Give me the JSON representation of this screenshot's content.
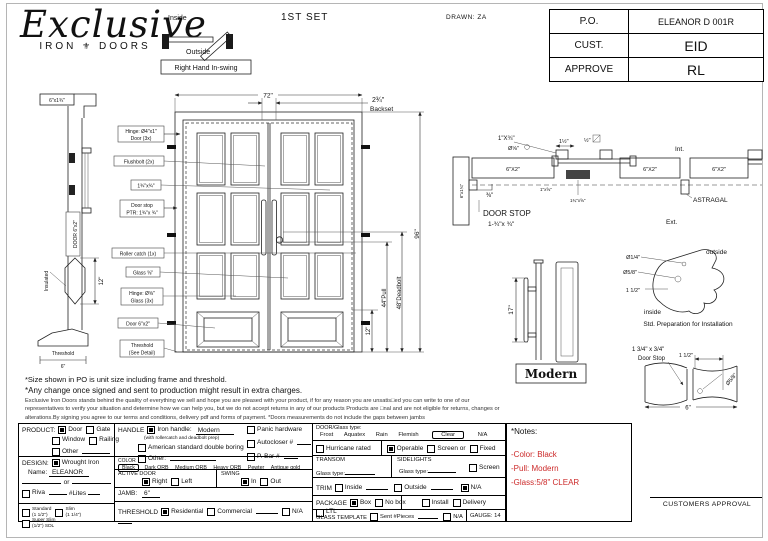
{
  "header": {
    "logo": {
      "script": "Exclusive",
      "sub_left": "IRON",
      "ornament": "⚜",
      "sub_right": "DOORS"
    },
    "set_label": "1ST SET",
    "drawn": "DRAWN: ZA",
    "swing": {
      "inside": "Inside",
      "outside": "Outside",
      "caption": "Right Hand In-swing"
    },
    "po_table": [
      [
        "P.O.",
        "ELEANOR D 001R"
      ],
      [
        "CUST.",
        "EID"
      ],
      [
        "APPROVE",
        "RL"
      ]
    ]
  },
  "drawing": {
    "elevation": {
      "dim_width": "72\"",
      "backset_value": "2¾\"",
      "backset_label": "Backset",
      "dim_height": "96\"",
      "dim_pull": "44\"Pull",
      "dim_deadbolt": "48\"Deadbolt",
      "dim_panel": "12\"",
      "callouts": [
        {
          "l1": "Hinge: Ø4\"x1\"",
          "l2": "Door (3x)"
        },
        {
          "l1": "Flushbolt (2x)"
        },
        {
          "l1": "1¾\"x¾\""
        },
        {
          "l1": "Door stop",
          "l2": "PTR: 1¾\"x ¾\""
        },
        {
          "l1": "Roller catch  (1x)"
        },
        {
          "l1": "Glass ⅝\""
        },
        {
          "l1": "Hinge: Ø⅝\"",
          "l2": "Glass (3x)"
        },
        {
          "l1": "Door 6\"x2\""
        },
        {
          "l1": "Threshold",
          "l2": "(See Detail)"
        }
      ]
    },
    "jamb": {
      "top": "6\"x1¾\"",
      "door": "DOOR 6\"x2\"",
      "insulated": "Insulated",
      "dim": "12\"",
      "threshold": "Threshold",
      "threshold_dim": "6\""
    },
    "plan": {
      "l_1x34": "1\"X¾\"",
      "l_d58": "Ø⅝\"",
      "l_112": "1½\"",
      "l_12": "½\"",
      "j1": "6\"X2\"",
      "j2": "6\"X2\"",
      "j3": "6\"X2\"",
      "l_38": "⅜\"",
      "side": "6\"x1¾\"",
      "int": "Int.",
      "ext": "Ext.",
      "astragal": "ASTRAGAL",
      "doorstop1": "DOOR STOP",
      "doorstop2": "1-¾\"x ¾\"",
      "t1": "1\"x⅝\"",
      "t2": "1¾\"x⅝\""
    },
    "handle": {
      "dim": "17\"",
      "name": "Modern"
    },
    "profile": {
      "d14": "Ø1/4\"",
      "d58": "Ø5/8\"",
      "d112": "1 1/2\"",
      "outside": "outside",
      "inside": "inside",
      "caption": "Std. Preparation for Installation"
    },
    "corner": {
      "size": "1 3/4\" x 3/4\"",
      "name": "Door Stop",
      "d112": "1 1/2\"",
      "d58": "Ø5/8\"",
      "d6": "6\""
    }
  },
  "notes": {
    "line1": "*Size shown in PO is unit size including frame and threshold.",
    "line2": "*Any change once signed and sent to production might result in extra charges.",
    "fine_print": "Exclusive Iron Doors stands behind the quality of everything we sell and hope you are pleased with your product, if for any reason you are unsatis□ed you can write to one of our representatives to verify your situation and determine how we can help you, but we do not accept returns in any of our products Products are □nal and are not eligible for returns, changes or alterations.By signing you agree to our terms and conditions, delivery pdf and forms of payment.  *Doors measurements do not include the gaps between jambs"
  },
  "form": {
    "product": {
      "title": "PRODUCT:",
      "items": [
        {
          "label": "Door",
          "checked": true
        },
        {
          "label": "Gate",
          "checked": false
        },
        {
          "label": "Window",
          "checked": false
        },
        {
          "label": "Railing",
          "checked": false
        },
        {
          "label": "Other",
          "checked": false
        }
      ]
    },
    "design": {
      "title": "DESIGN:",
      "wrought": {
        "label": "Wrought Iron",
        "checked": true
      },
      "name_label": "Name:",
      "name_value": "ELEANOR",
      "or": "or",
      "riva": {
        "label": "Riva",
        "checked": false
      },
      "lites": "#Lites",
      "sdl": [
        {
          "label": "Standard",
          "sub": "(1 1/2\")",
          "checked": false
        },
        {
          "label": "Slim",
          "sub": "(1 1/4\")",
          "checked": false
        },
        {
          "label": "Super Slim",
          "sub": "(1/2\") SDL",
          "checked": false
        }
      ]
    },
    "handle": {
      "title": "HANDLE",
      "iron": {
        "label": "Iron handle:",
        "value": "Modern",
        "checked": true,
        "note": "(with rollercatch and deadbolt prep)"
      },
      "american": {
        "label": "American standard double boring",
        "checked": false
      },
      "other": {
        "label": "Other:",
        "checked": false
      },
      "panic": {
        "label": "Panic hardware",
        "checked": false
      },
      "autocloser": {
        "label": "Autocloser #",
        "checked": false
      },
      "pbar": {
        "label": "P. Bar #",
        "checked": false
      }
    },
    "color": {
      "title": "COLOR",
      "selected": "Black",
      "options": [
        "Dark ORB",
        "Medium ORB",
        "Heavy ORB",
        "Pewter",
        "Antique gold"
      ]
    },
    "active_door": {
      "title": "ACTIVE DOOR",
      "right": {
        "label": "Right",
        "checked": true
      },
      "left": {
        "label": "Left",
        "checked": false
      }
    },
    "swing": {
      "title": "SWING",
      "in": {
        "label": "In",
        "checked": true
      },
      "out": {
        "label": "Out",
        "checked": false
      }
    },
    "jamb": {
      "title": "JAMB:",
      "value": "6\""
    },
    "threshold": {
      "title": "THRESHOLD",
      "residential": {
        "label": "Residential",
        "checked": true
      },
      "commercial": {
        "label": "Commercial",
        "checked": false
      },
      "na": {
        "label": "N/A",
        "checked": false
      }
    },
    "glass": {
      "title": "DOOR/Glass type:",
      "options": [
        "Frost",
        "Aquatex",
        "Rain",
        "Flemish",
        "Clear",
        "N/A"
      ],
      "selected": "Clear",
      "hurricane": {
        "label": "Hurricane rated",
        "checked": false
      },
      "operable": {
        "label": "Operable",
        "checked": true
      },
      "screen_or": {
        "label": "Screen or",
        "checked": false
      },
      "fixed": {
        "label": "Fixed",
        "checked": false
      }
    },
    "transom": {
      "title": "TRANSOM",
      "glass_label": "Glass type:"
    },
    "sidelights": {
      "title": "SIDELIGHTS",
      "glass_label": "Glass type:",
      "screen": {
        "label": "Screen",
        "checked": false
      }
    },
    "trim": {
      "title": "TRIM",
      "inside": {
        "label": "Inside",
        "checked": false
      },
      "outside": {
        "label": "Outside",
        "checked": false
      },
      "na": {
        "label": "N/A",
        "checked": true
      }
    },
    "package": {
      "title": "PACKAGE",
      "box": {
        "label": "Box",
        "checked": true
      },
      "nobox": {
        "label": "No box",
        "checked": false
      },
      "install": {
        "label": "Install",
        "checked": false
      },
      "delivery": {
        "label": "Delivery",
        "checked": false
      },
      "ltl": {
        "label": "LTL",
        "checked": false
      }
    },
    "glass_template": {
      "title": "GLASS TEMPLATE",
      "sent": {
        "label": "Sent #Pieces",
        "checked": false
      },
      "na": {
        "label": "N/A",
        "checked": false
      },
      "gauge": "GAUGE: 14"
    }
  },
  "side_notes": {
    "title": "*Notes:",
    "items": [
      "-Color: Black",
      "-Pull: Modern",
      "-Glass:5/8\" CLEAR"
    ],
    "accent": "#cc2a2a"
  },
  "approval": {
    "label": "CUSTOMERS APPROVAL"
  }
}
